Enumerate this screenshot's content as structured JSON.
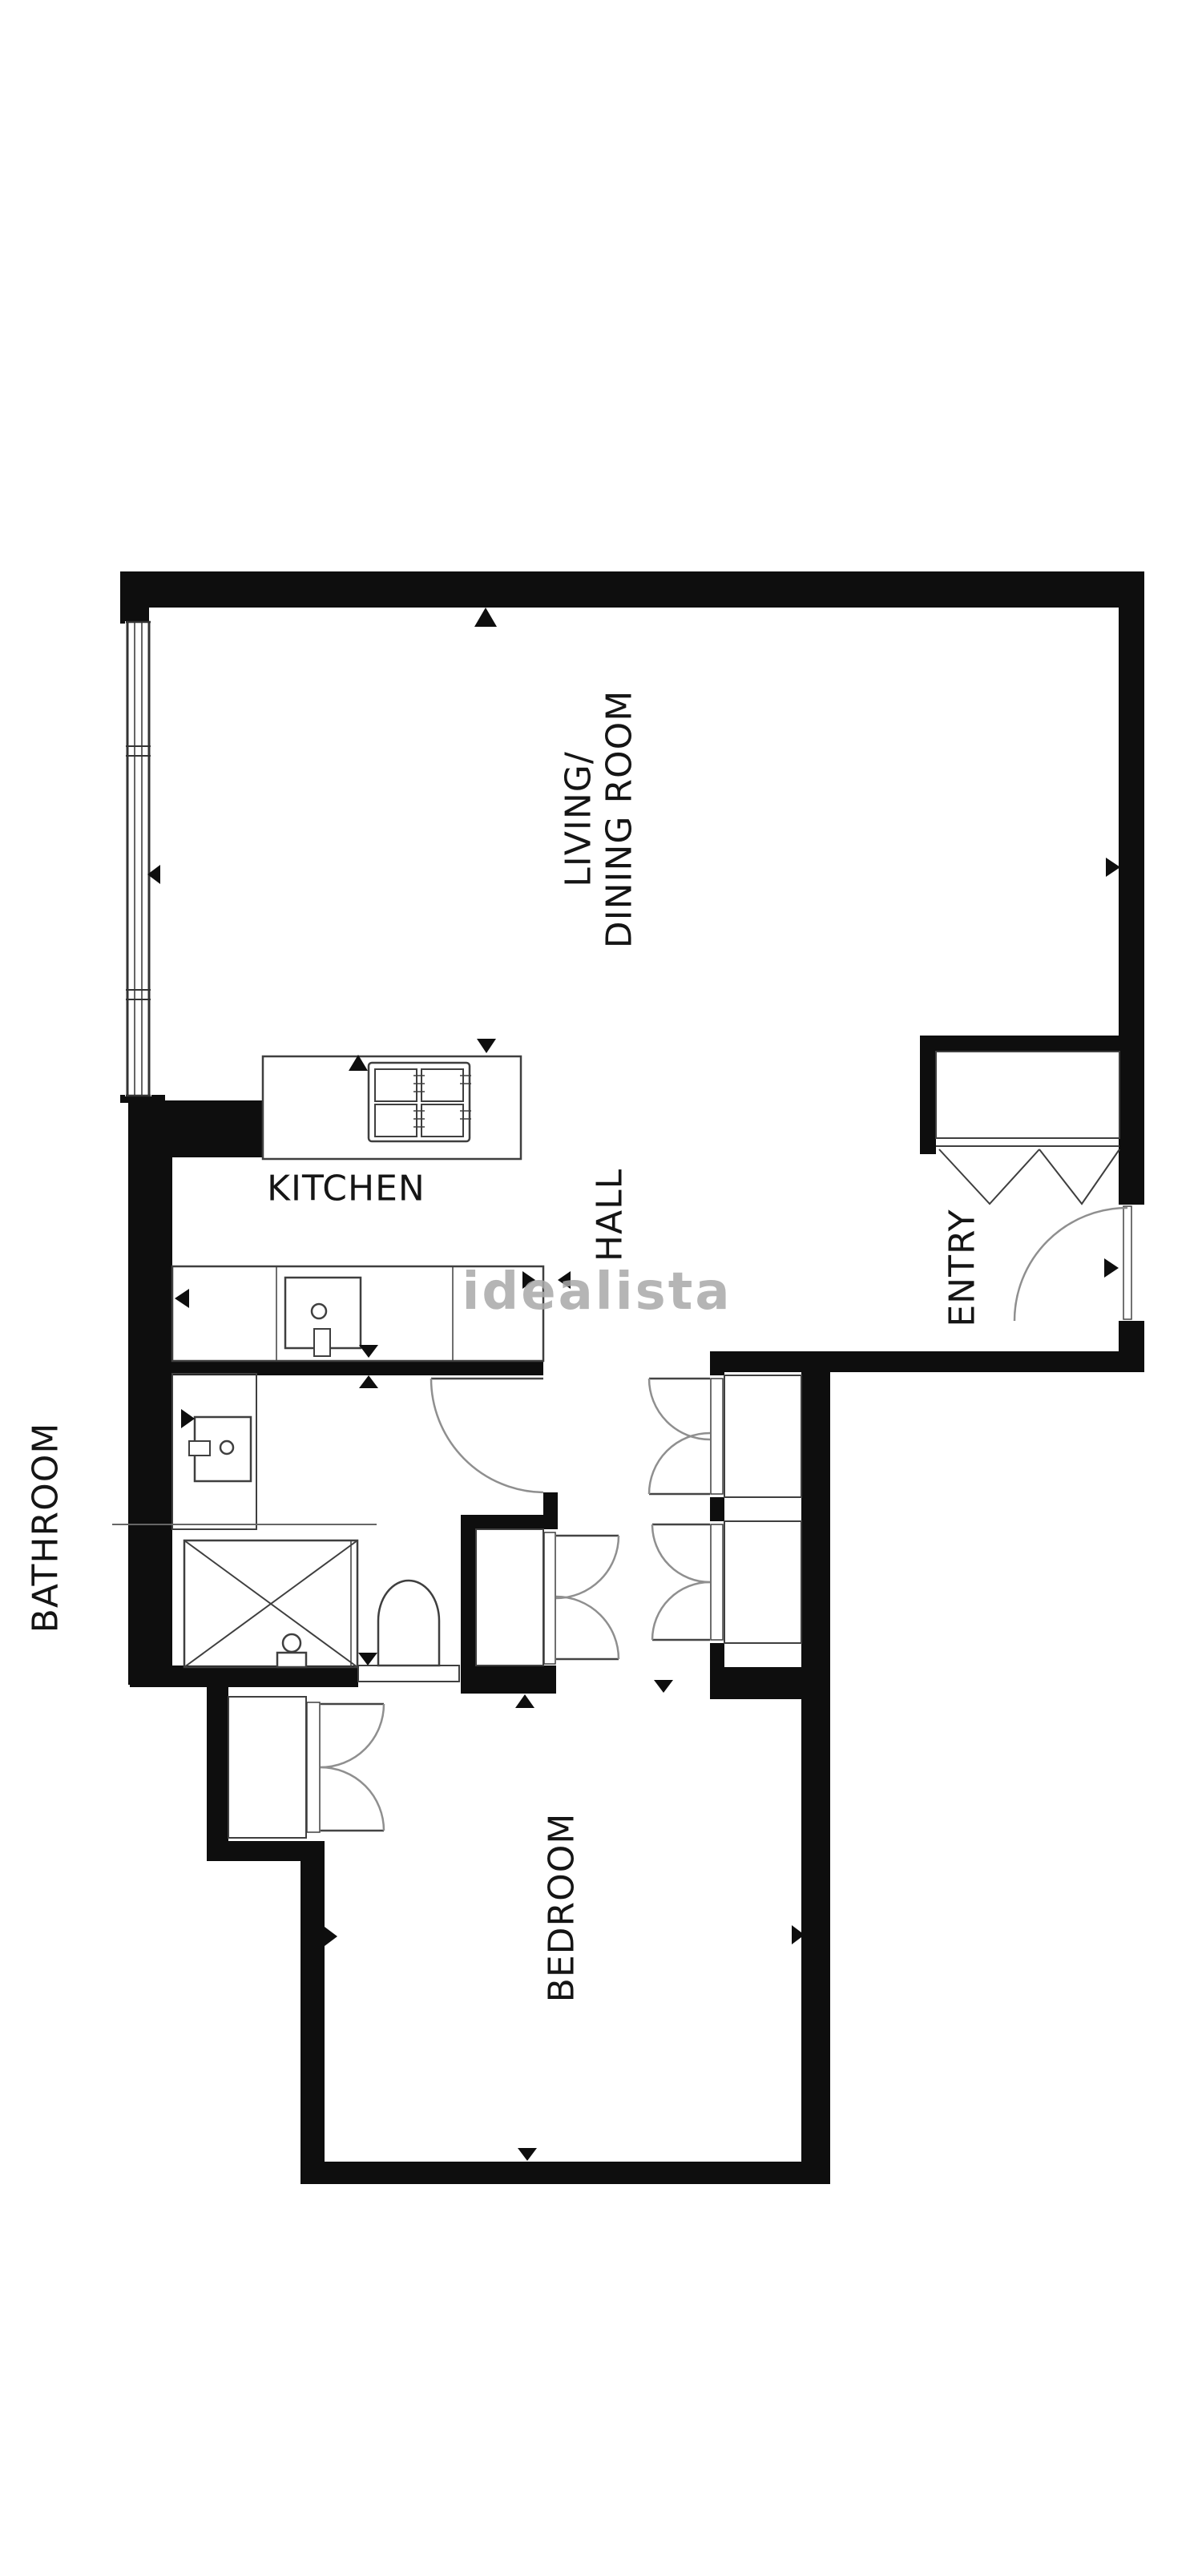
{
  "floorplan": {
    "watermark": "idealista",
    "labels": {
      "living_line1": "LIVING/",
      "living_line2": "DINING ROOM",
      "kitchen": "KITCHEN",
      "hall": "HALL",
      "entry": "ENTRY",
      "bathroom": "BATHROOM",
      "bedroom": "BEDROOM"
    },
    "colors": {
      "wall": "#0e0e0e",
      "thin_line": "#3f3f3f",
      "door_arc": "#8f8f8f",
      "label_text": "#151515",
      "watermark_gray": "#a9a9a9",
      "background": "#ffffff"
    }
  }
}
